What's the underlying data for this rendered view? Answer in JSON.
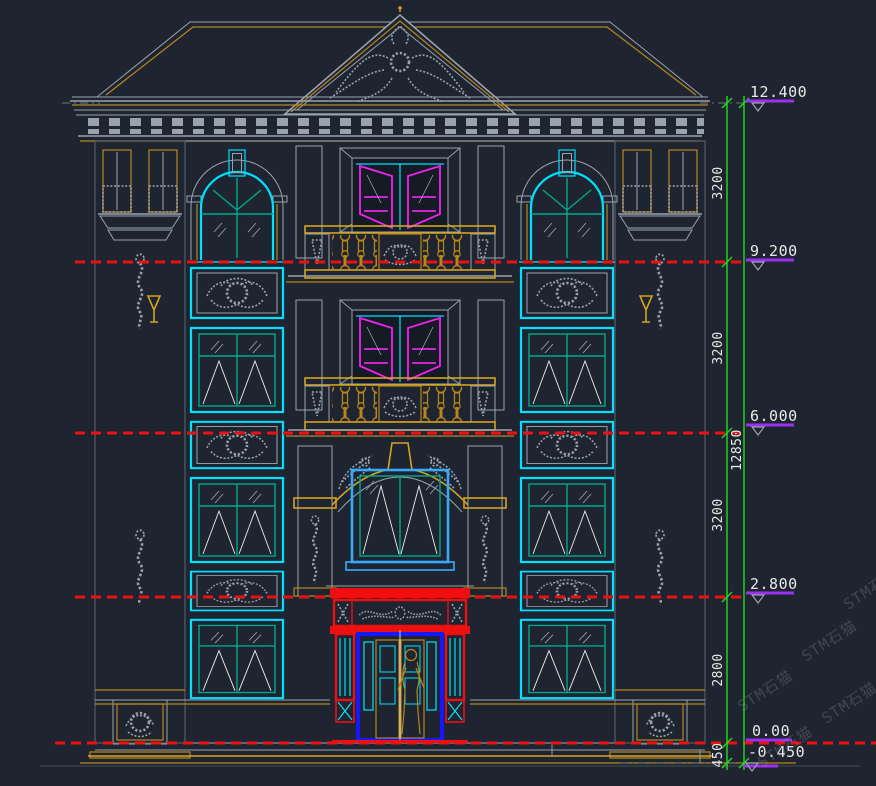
{
  "palette": {
    "bg": "#1e2530",
    "red": "#ee1010",
    "cyan": "#00e0ff",
    "azure": "#36aaff",
    "blue": "#1616ff",
    "magenta": "#ee22ee",
    "gold": "#b8871d",
    "goldBright": "#d8a31f",
    "green": "#1ede1e",
    "teal": "#00a98c",
    "gray": "#9aa3ad",
    "grayDim": "#6b7480",
    "wallLine": "#414c58",
    "bandLine": "#5c6772",
    "violet": "#9b30f0",
    "white": "#efefef",
    "dimText": "#e9e9e9",
    "watermark": "#949ca6",
    "roofTileRed": "#e60c0c",
    "glass": "#151b24"
  },
  "levels": [
    {
      "label": "12.400"
    },
    {
      "label": "9.200"
    },
    {
      "label": "6.000"
    },
    {
      "label": "2.800"
    },
    {
      "label": "0.00"
    },
    {
      "label": "-0.450"
    }
  ],
  "dims": {
    "segments": [
      "3200",
      "3200",
      "3200",
      "2800",
      "450"
    ],
    "total": "12850"
  },
  "watermark": {
    "text": "STM石猫"
  }
}
